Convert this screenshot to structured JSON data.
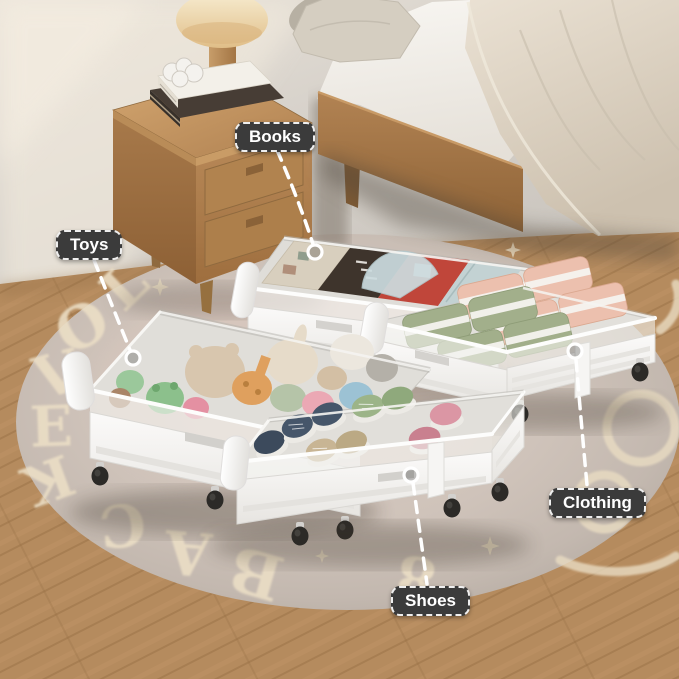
{
  "annotations": {
    "books_label": "Books",
    "toys_label": "Toys",
    "clothing_label": "Clothing",
    "shoes_label": "Shoes"
  },
  "rug_text": {
    "left_letters": [
      "L",
      "O",
      "V",
      "E"
    ],
    "bottom_letters": [
      "B",
      "A",
      "C",
      "K"
    ],
    "numeral": "8"
  },
  "palette": {
    "label_bg": "#3b3b3b",
    "label_text": "#ffffff",
    "connector_line": "#ffffff",
    "wall": "#d6d1ca",
    "floor_wood": "#b58b5e",
    "rug": "#cfc3ba",
    "rug_text": "#ecdfc6",
    "furniture_wood": "#b8895a",
    "drawer_white": "#f6f5f3",
    "clothes_pink": "#ecc0ae",
    "clothes_green": "#a2af8b",
    "lamp_shade": "#efdcb2",
    "wheel_black": "#2c2a27"
  }
}
